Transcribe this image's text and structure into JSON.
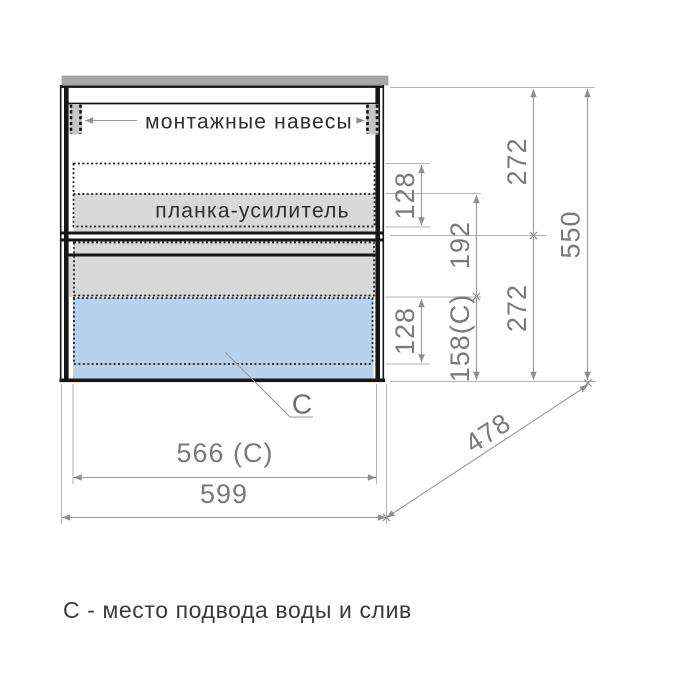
{
  "labels": {
    "mounting_hangers": "монтажные навесы",
    "reinforcement_strip": "планка-усилитель",
    "c_marker": "С"
  },
  "dimensions": {
    "top_section_height": "272",
    "bottom_section_height": "272",
    "total_height": "550",
    "strip_zone_height": "128",
    "strip_offset": "192",
    "drain_zone_height": "128",
    "drain_offset": "158(С)",
    "inner_width": "566 (С)",
    "total_width": "599",
    "depth": "478"
  },
  "caption": "С - место подвода воды и слив",
  "colors": {
    "drain_zone_blue": "#b9d2ec",
    "panel_gray": "#d8d8d8",
    "hanger_gray": "#c6c6c6",
    "countertop_gray": "#a8a8a8",
    "dimension_line": "#9a9a9a",
    "dimension_text": "#7a7a7a",
    "outline_black": "#161616"
  }
}
